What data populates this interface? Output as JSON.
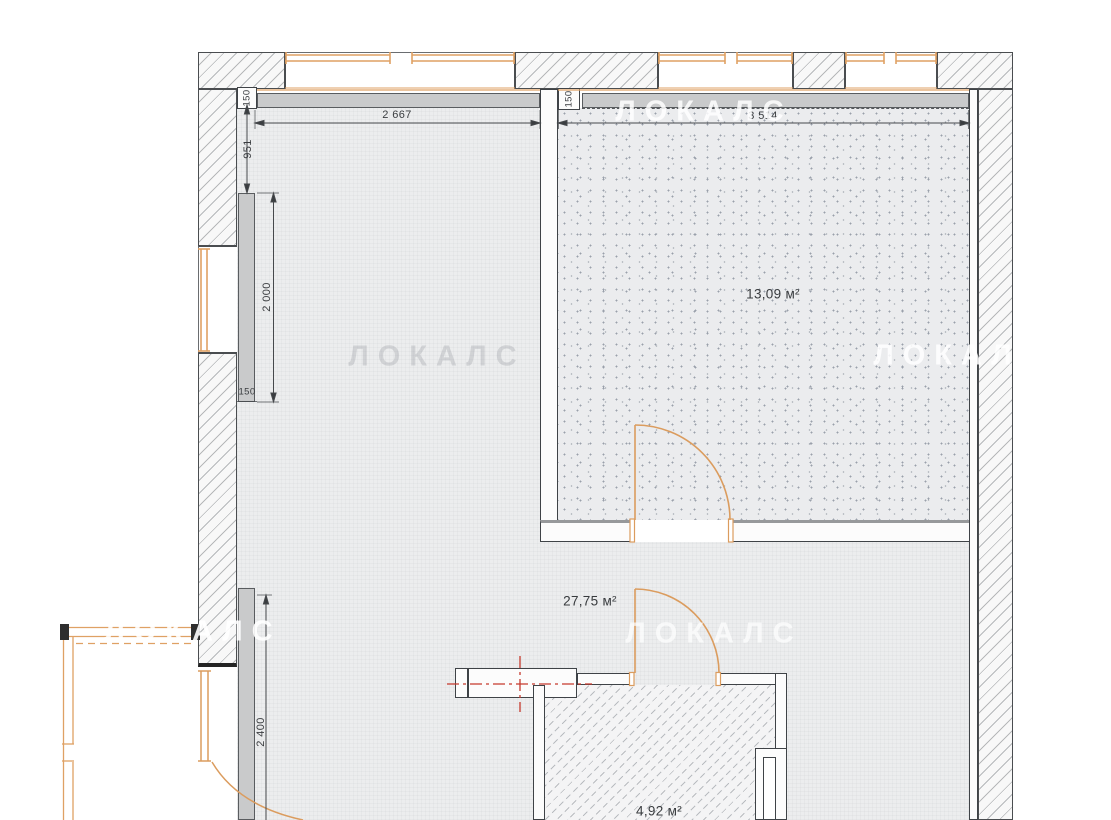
{
  "plan": {
    "rooms": [
      {
        "id": "room-13",
        "area_label": "13,09 м²"
      },
      {
        "id": "room-27",
        "area_label": "27,75 м²"
      },
      {
        "id": "room-4",
        "area_label": "4,92 м²"
      }
    ],
    "dimensions": {
      "top_left_width": "2 667",
      "top_right_width": "3 514",
      "left_upper_segment": "951",
      "wall_thickness_left": "150",
      "wall_thickness_right": "150",
      "left_niche_height": "2 000",
      "left_niche_width": "150",
      "left_lower_height": "2 400"
    },
    "watermark": "ЛОКАЛС",
    "colors": {
      "wall_line": "#3f4347",
      "accent_orange": "#dfa164",
      "centerline_red": "#c5392d",
      "gray_fill": "#c9cacb"
    }
  }
}
